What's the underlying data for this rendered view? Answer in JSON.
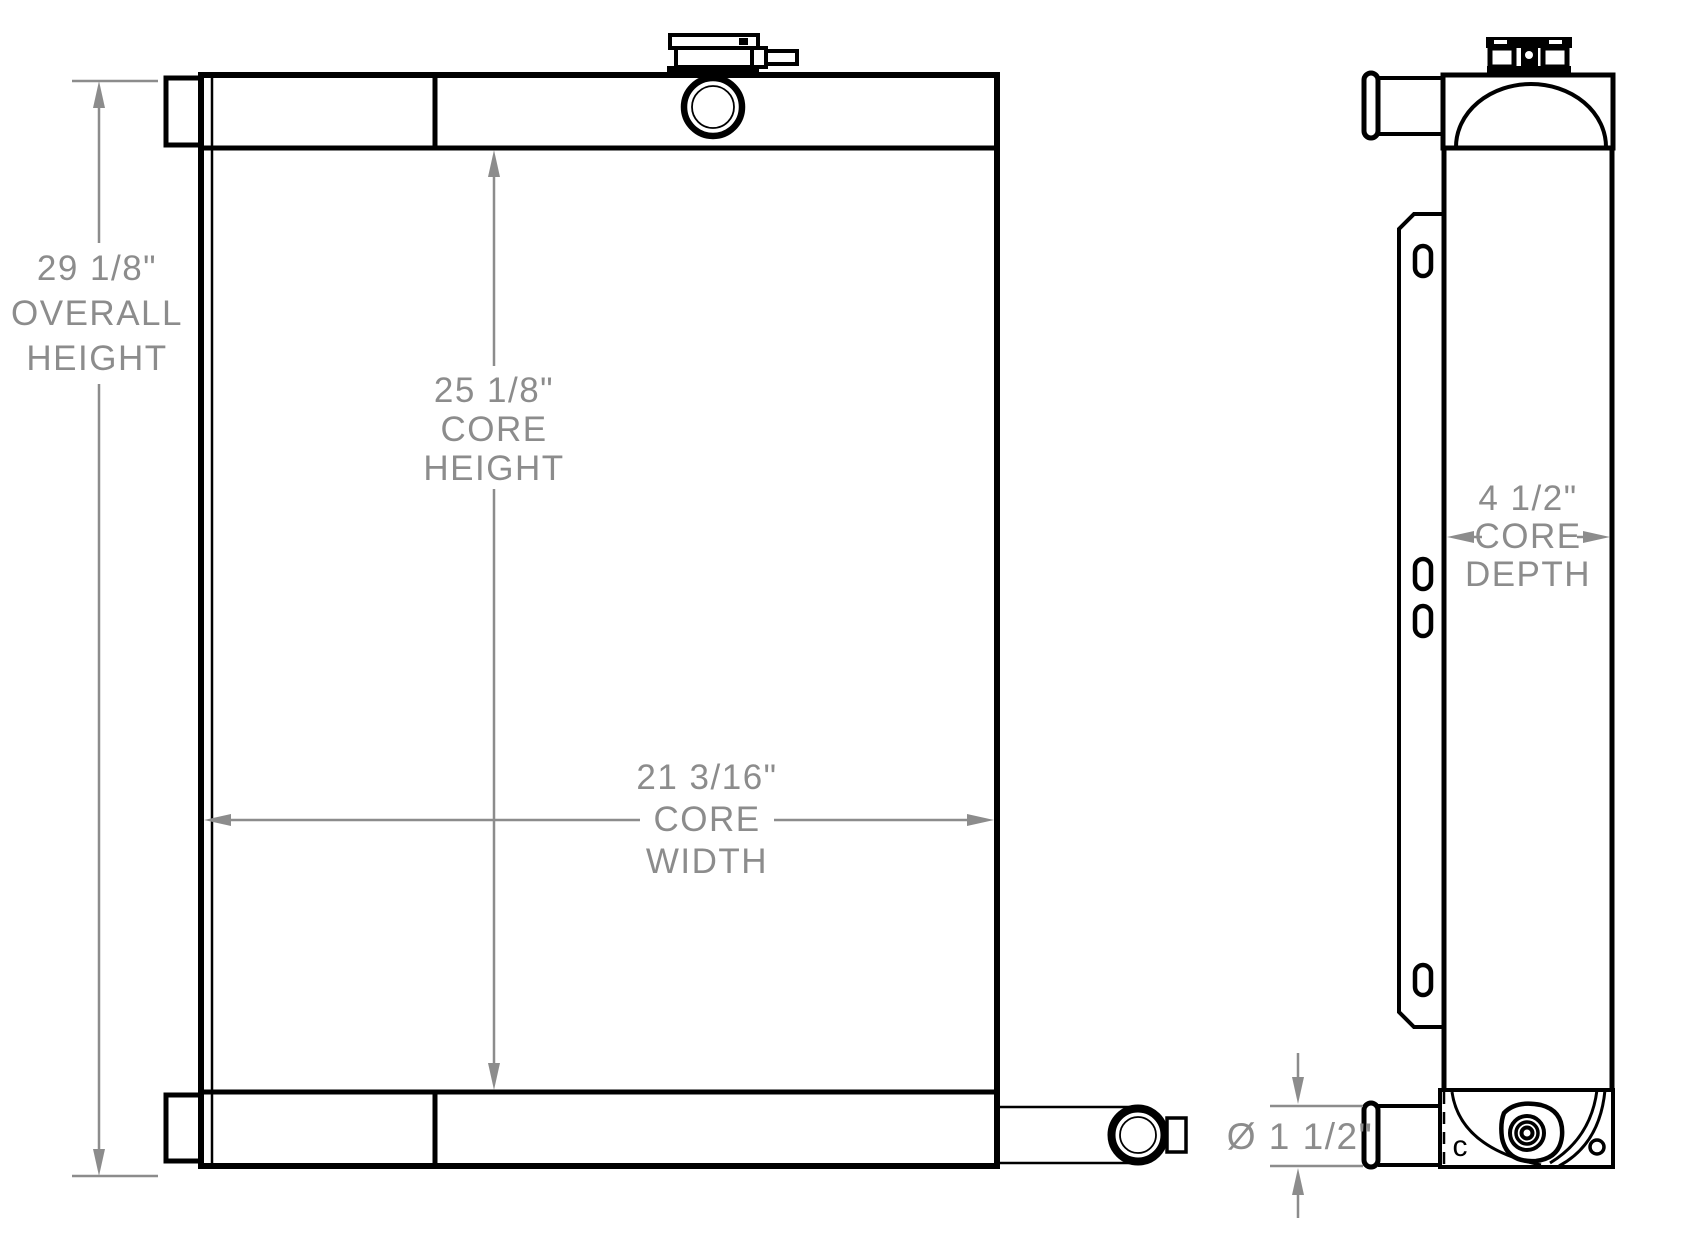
{
  "dimensions": {
    "overall_height": {
      "lines": [
        "29 1/8\"",
        "OVERALL",
        "HEIGHT"
      ]
    },
    "core_height": {
      "lines": [
        "25 1/8\"",
        "CORE",
        "HEIGHT"
      ]
    },
    "core_width": {
      "lines": [
        "21 3/16\"",
        "CORE",
        "WIDTH"
      ]
    },
    "core_depth": {
      "lines": [
        "4 1/2\"",
        "CORE",
        "DEPTH"
      ]
    },
    "outlet_diameter": {
      "label": "Ø 1 1/2\""
    }
  },
  "annotations": {
    "tank_letter": "c"
  },
  "colors": {
    "line": "#000000",
    "dimension": "#8c8c8c",
    "background": "#ffffff"
  }
}
